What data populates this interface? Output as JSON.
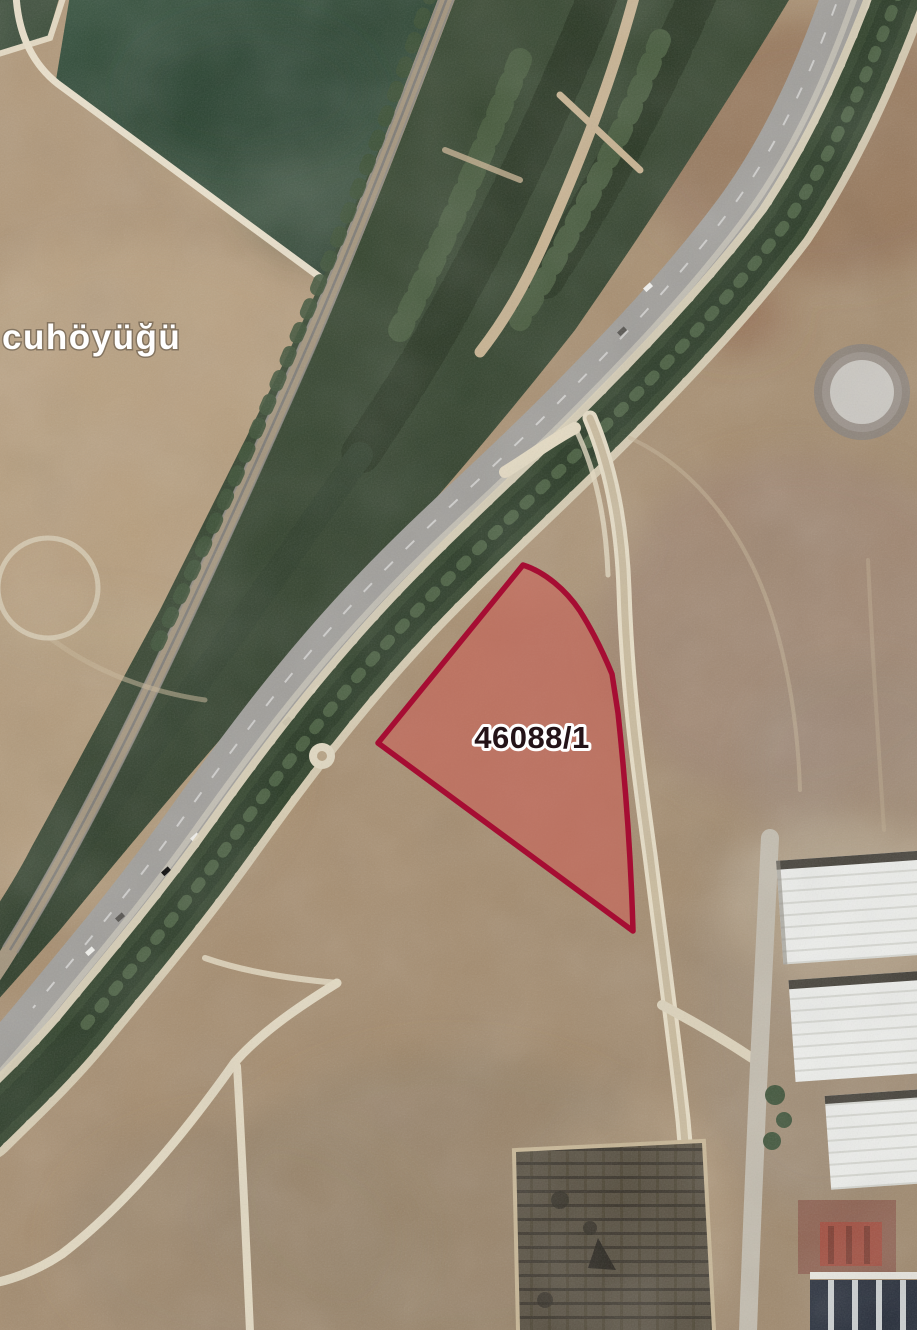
{
  "map": {
    "place_label": "cuhöyüğü",
    "place_label_color": "#ffffff",
    "parcel": {
      "label": "46088/1",
      "outline_color": "#a60d33",
      "fill_color": "#cf5a52",
      "fill_opacity": "0.52",
      "label_color": "#241318",
      "label_halo_color": "#ffffff"
    },
    "landmarks": {
      "circular_pad_outer_color": "#8b8177",
      "circular_pad_inner_color": "#cbc8c2"
    }
  }
}
